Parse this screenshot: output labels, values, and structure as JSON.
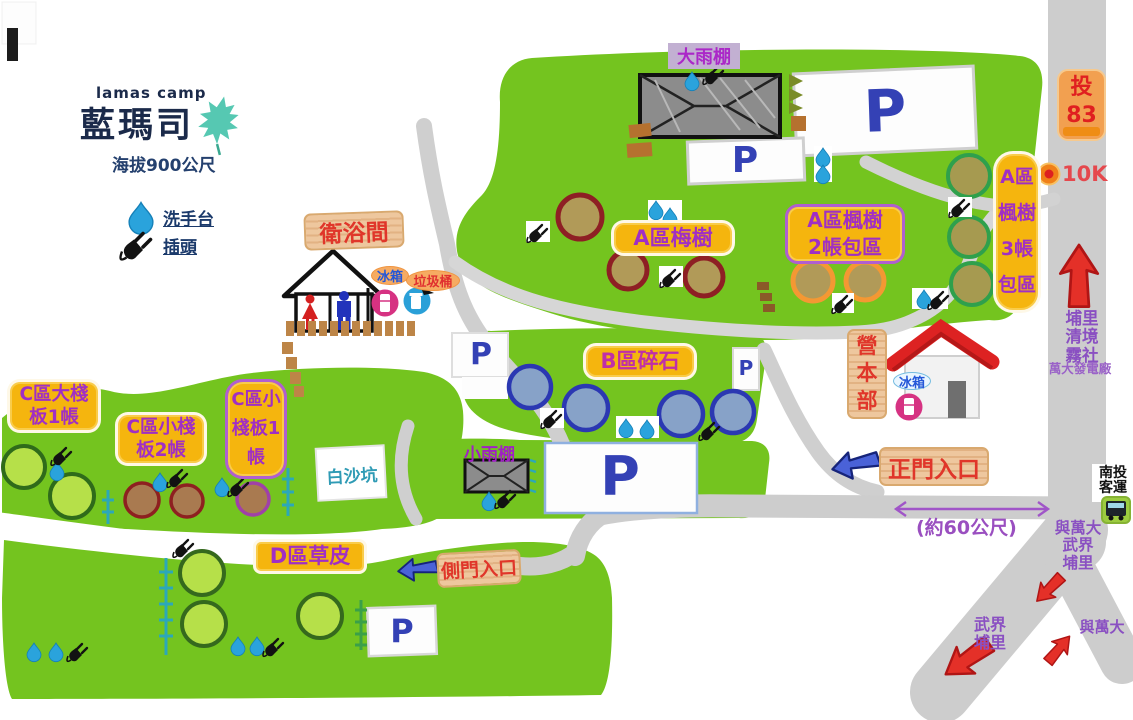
{
  "colors": {
    "map_green": "#74c41f",
    "road_gray": "#cdcdcd",
    "label_yellow": "#f5b50e",
    "zone_text_purple": "#a02fc4",
    "wood_sign_red": "#e0362a",
    "parking_blue": "#3441b5",
    "water_blue": "#2aa3dc",
    "arrow_red": "#e43028",
    "leaf_teal": "#56c8b2"
  },
  "title": {
    "en": "lamas camp",
    "zh": "藍瑪司",
    "elevation": "海拔900公尺"
  },
  "legend": {
    "water": "洗手台",
    "plug": "插頭"
  },
  "labels": {
    "bathroom": "衛浴間",
    "bathroom_fridge": "冰箱",
    "trash": "垃圾桶",
    "big_shelter": "大雨棚",
    "small_shelter": "小雨棚",
    "white_sand": "白沙坑",
    "hq": "營本部",
    "hq_fridge": "冰箱",
    "main_entrance": "正門入口",
    "side_entrance": "側門入口",
    "distance": "(約60公尺)",
    "parking": "P"
  },
  "zones": {
    "a_plum": "A區梅樹",
    "a_maple2": [
      "A區楓樹",
      "2帳包區"
    ],
    "a_maple3": [
      "A區",
      "楓樹",
      "3帳",
      "包區"
    ],
    "b_gravel": "B區碎石",
    "c_large": [
      "C區大棧",
      "板1帳"
    ],
    "c_small2": [
      "C區小棧",
      "板2帳"
    ],
    "c_small1": [
      "C區小",
      "棧板1",
      "帳"
    ],
    "d_grass": "D區草皮"
  },
  "roadside": {
    "route_name": "投",
    "route_number": "83",
    "milestone": "10K",
    "north_dest": [
      "埔里",
      "清境",
      "霧社"
    ],
    "power_plant": "萬大發電廠",
    "bus_stop": [
      "南投",
      "客運"
    ],
    "junction_dest": [
      "與萬大",
      "武界",
      "埔里"
    ],
    "fork_left_dest": [
      "武界",
      "埔里"
    ],
    "fork_right_dest": "與萬大"
  }
}
